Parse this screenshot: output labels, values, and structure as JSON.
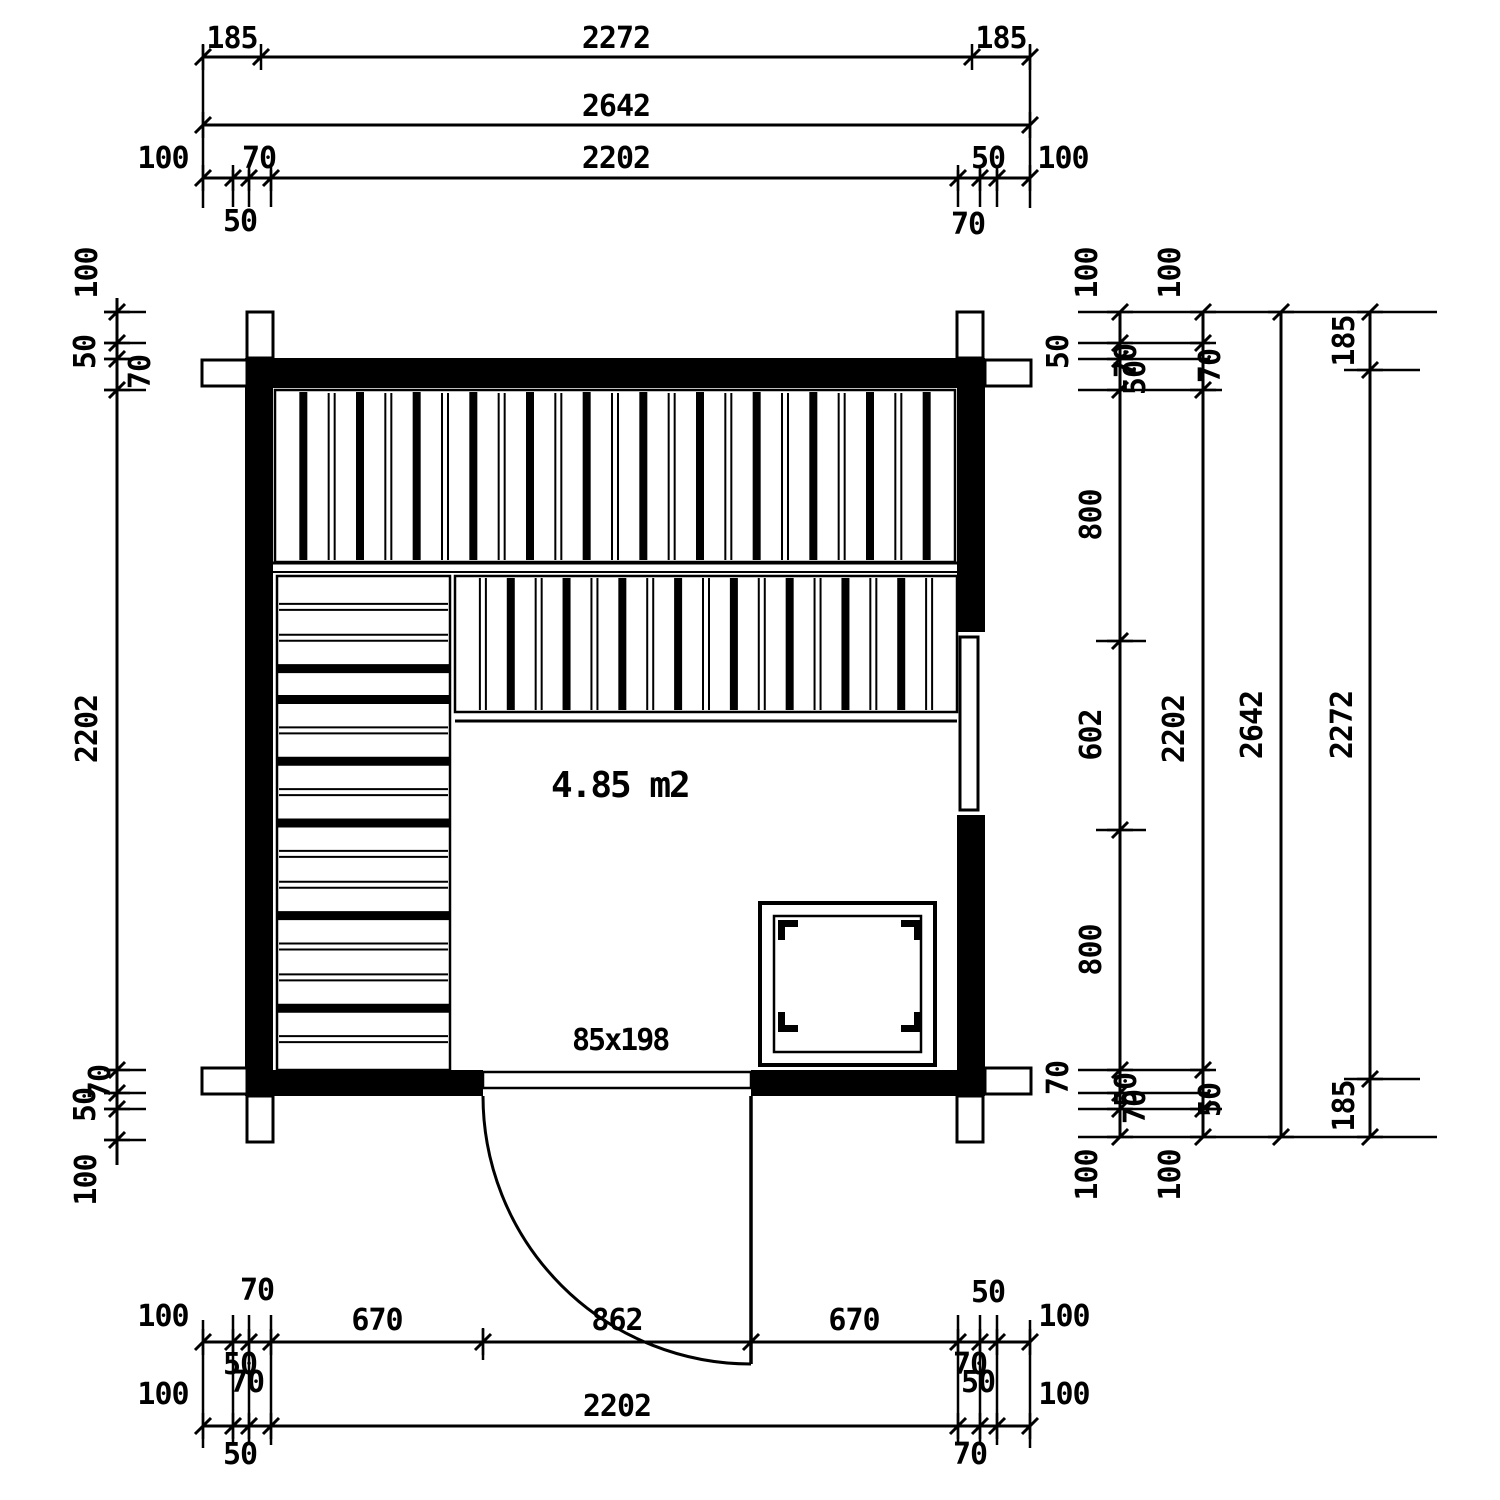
{
  "plan": {
    "area_label": "4.85 m2",
    "door_label": "85x198"
  },
  "colors": {
    "ink": "#000000",
    "paper": "#ffffff"
  },
  "dims": {
    "top": {
      "row1_left": "185",
      "row1_mid": "2272",
      "row1_right": "185",
      "row2_total": "2642",
      "row3_left100": "100",
      "row3_left70": "70",
      "row3_mid": "2202",
      "row3_right50": "50",
      "row3_right100": "100",
      "below_left50": "50",
      "below_right70": "70"
    },
    "left": {
      "top100": "100",
      "top50": "50",
      "top70": "70",
      "mid": "2202",
      "bottom70": "70",
      "bottom50": "50",
      "bottom100": "100"
    },
    "right": {
      "r1_top100": "100",
      "r2_top100": "100",
      "r1_top50": "50",
      "r1_ov70": "70",
      "r1_ov50": "50",
      "r2_top70": "70",
      "r1_seg800a": "800",
      "r1_seg602": "602",
      "r1_seg800b": "800",
      "r2_mid": "2202",
      "r3_total": "2642",
      "r4_top185": "185",
      "r4_mid": "2272",
      "r4_bottom185": "185",
      "r1_bottom70": "70",
      "r1_bov50": "50",
      "r1_bov70": "70",
      "r2_bottom50": "50",
      "r1_bottom100": "100",
      "r2_bottom100": "100"
    },
    "bottom": {
      "above_left70": "70",
      "above_right50": "50",
      "row1_left100": "100",
      "row1_670a": "670",
      "row1_862": "862",
      "row1_670b": "670",
      "row1_right100": "100",
      "ovl_50": "50",
      "ovl_70": "70",
      "ovr_70": "70",
      "ovr_50": "50",
      "row2_left100": "100",
      "row2_mid": "2202",
      "row2_right100": "100",
      "below_left50": "50",
      "below_right70": "70"
    }
  }
}
